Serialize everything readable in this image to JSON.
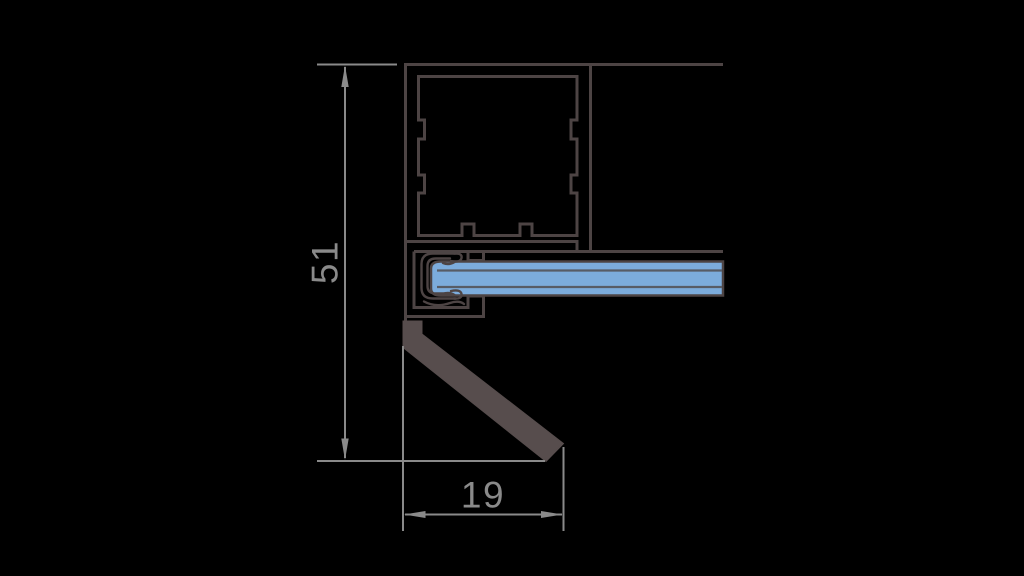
{
  "drawing": {
    "title": "aluminium-glazing-profile-cross-section",
    "dimensions": {
      "height": {
        "value": "51",
        "orientation": "vertical"
      },
      "width": {
        "value": "19",
        "orientation": "horizontal"
      }
    }
  },
  "colors": {
    "background": "#000000",
    "outline": "#4d4444",
    "gasket-fill": "#574d4d",
    "glass-fill": "#7cacdc",
    "glass-line": "#575c66",
    "dimension": "#8a8a8a"
  }
}
